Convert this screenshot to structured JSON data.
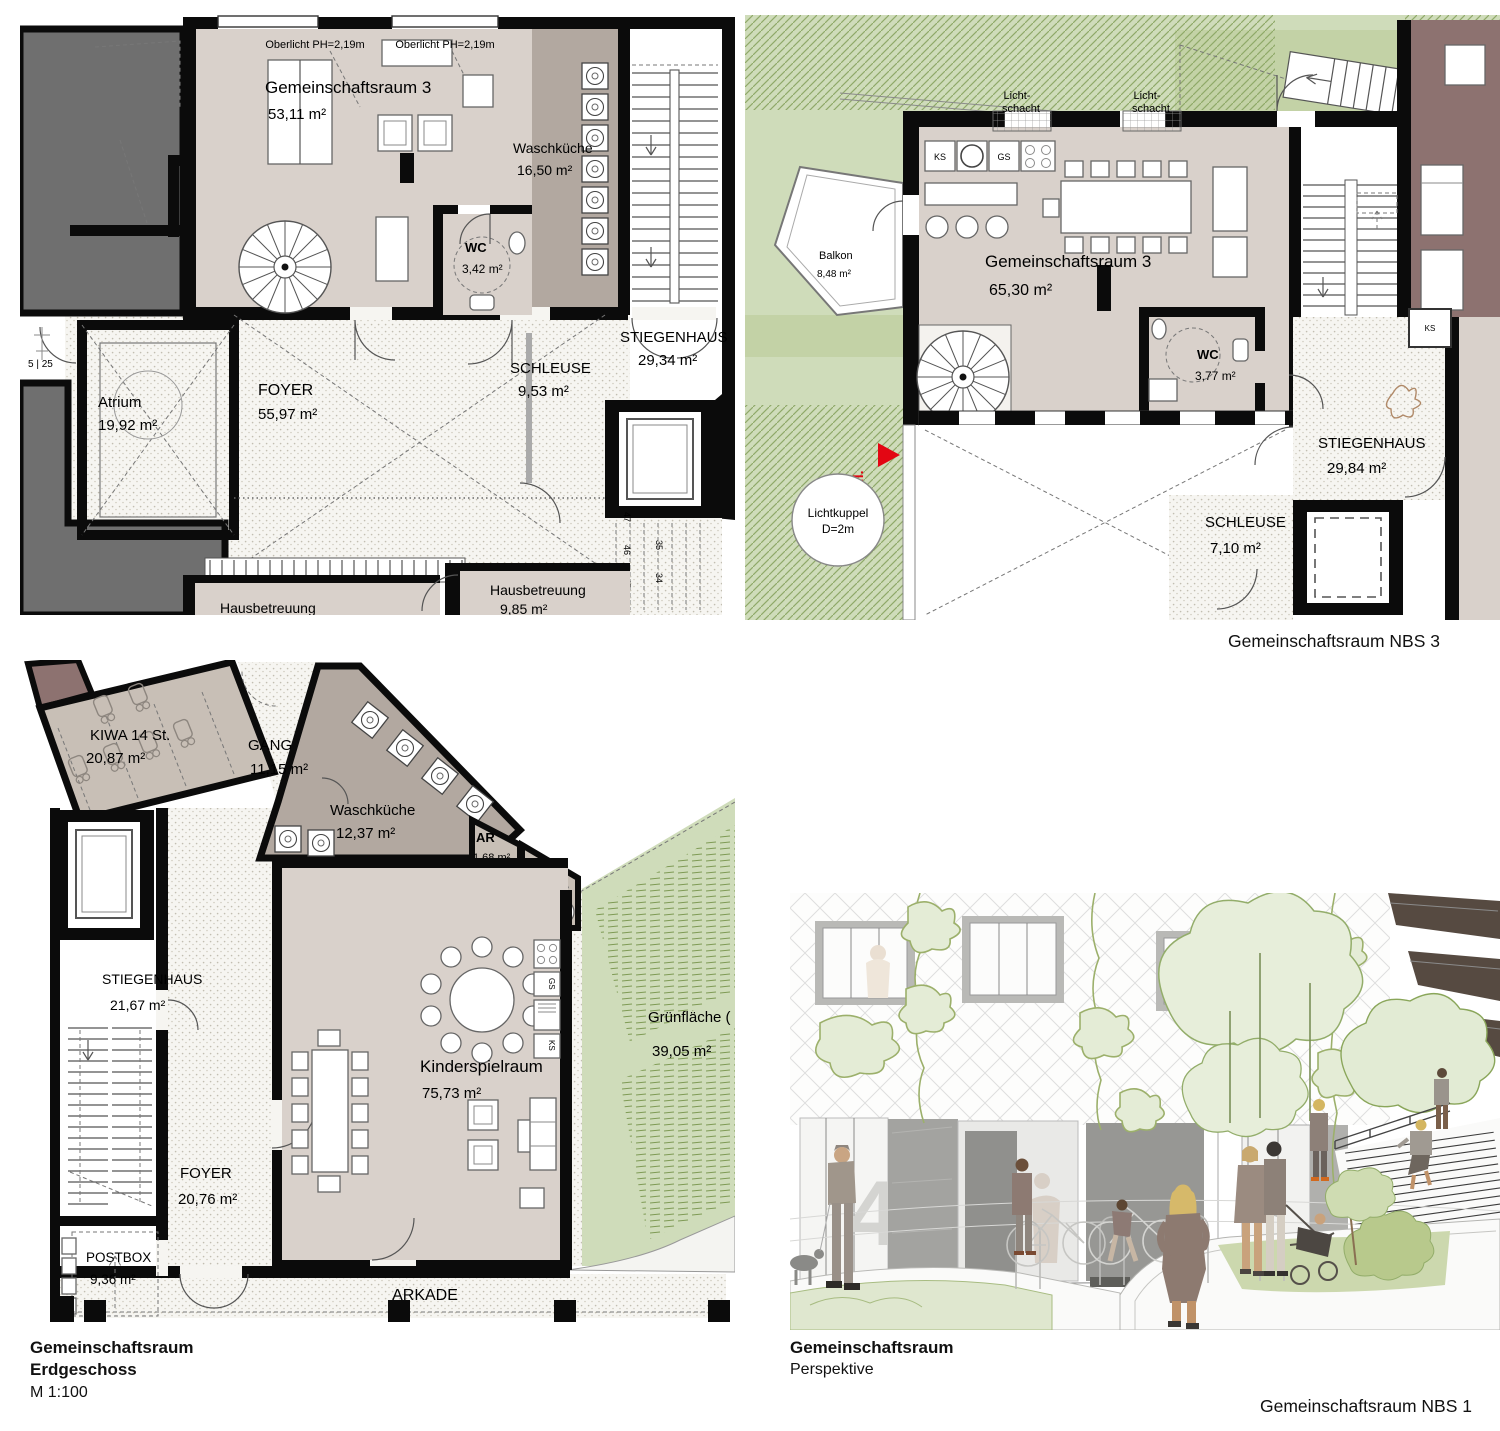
{
  "colors": {
    "accent_red": "#e30613",
    "room_beige": "#d9d1cb",
    "room_taupe": "#b2a8a0",
    "green": "#cfdcba",
    "mauve": "#8d7270",
    "wall_black": "#0b0b0b"
  },
  "captions": {
    "nbs3": "Gemeinschaftsraum NBS 3",
    "nbs1": "Gemeinschaftsraum NBS 1",
    "plan_bl_title": "Gemeinschaftsraum",
    "plan_bl_level": "Erdgeschoss",
    "plan_bl_scale": "M 1:100",
    "persp_title": "Gemeinschaftsraum",
    "persp_sub": "Perspektive"
  },
  "plan_top_left": {
    "oberlicht_left": "Oberlicht PH=2,19m",
    "oberlicht_right": "Oberlicht PH=2,19m",
    "gemeinschaftsraum_name": "Gemeinschaftsraum 3",
    "gemeinschaftsraum_area": "53,11 m²",
    "waschkueche_name": "Waschküche",
    "waschkueche_area": "16,50 m²",
    "wc_name": "WC",
    "wc_area": "3,42 m²",
    "atrium_name": "Atrium",
    "atrium_area": "19,92 m²",
    "foyer_name": "FOYER",
    "foyer_area": "55,97 m²",
    "schleuse_name": "SCHLEUSE",
    "schleuse_area": "9,53 m²",
    "stiegenhaus_name": "STIEGENHAUS",
    "stiegenhaus_area": "29,34 m²",
    "hausbetreuung_right_name": "Hausbetreuung",
    "hausbetreuung_right_area": "9,85 m²",
    "hausbetreuung_left_name": "Hausbetreuung",
    "mark_5_25": "5 | 25",
    "step_47": "47",
    "step_46": "46",
    "step_45": "45",
    "step_35": "35",
    "step_34": "34"
  },
  "plan_top_right": {
    "lichtschacht1_l1": "Licht-",
    "lichtschacht1_l2": "schacht",
    "lichtschacht2_l1": "Licht-",
    "lichtschacht2_l2": "schacht",
    "balkon_name": "Balkon",
    "balkon_area": "8,48 m²",
    "ks": "KS",
    "gs": "GS",
    "ks_neighbor": "KS",
    "gemeinschaftsraum_name": "Gemeinschaftsraum 3",
    "gemeinschaftsraum_area": "65,30 m²",
    "wc_name": "WC",
    "wc_area": "3,77 m²",
    "stiegenhaus_name": "STIEGENHAUS",
    "stiegenhaus_area": "29,84 m²",
    "schleuse_name": "SCHLEUSE",
    "schleuse_area": "7,10 m²",
    "lichtkuppel_l1": "Lichtkuppel",
    "lichtkuppel_l2": "D=2m",
    "bfl": "Bfl."
  },
  "plan_bottom_left": {
    "kiwa_name": "KIWA 14 St.",
    "kiwa_area": "20,87 m²",
    "gang_name": "GANG",
    "gang_area": "11,15 m²",
    "waschkueche_name": "Waschküche",
    "waschkueche_area": "12,37 m²",
    "ar_name": "AR",
    "ar_area": "1,68 m²",
    "wc_name": "WC",
    "wc_area": "3,62 m²",
    "kinderspielraum_name": "Kinderspielraum",
    "kinderspielraum_area": "75,73 m²",
    "stiegenhaus_name": "STIEGENHAUS",
    "stiegenhaus_area": "21,67 m²",
    "foyer_name": "FOYER",
    "foyer_area": "20,76 m²",
    "postbox_name": "POSTBOX",
    "postbox_area": "9,36 m²",
    "arkade": "ARKADE",
    "gruenflaeche_name": "Grünfläche (",
    "gruenflaeche_area": "39,05 m²",
    "gs": "GS",
    "ks": "KS"
  },
  "perspective": {
    "door_number": "4"
  }
}
